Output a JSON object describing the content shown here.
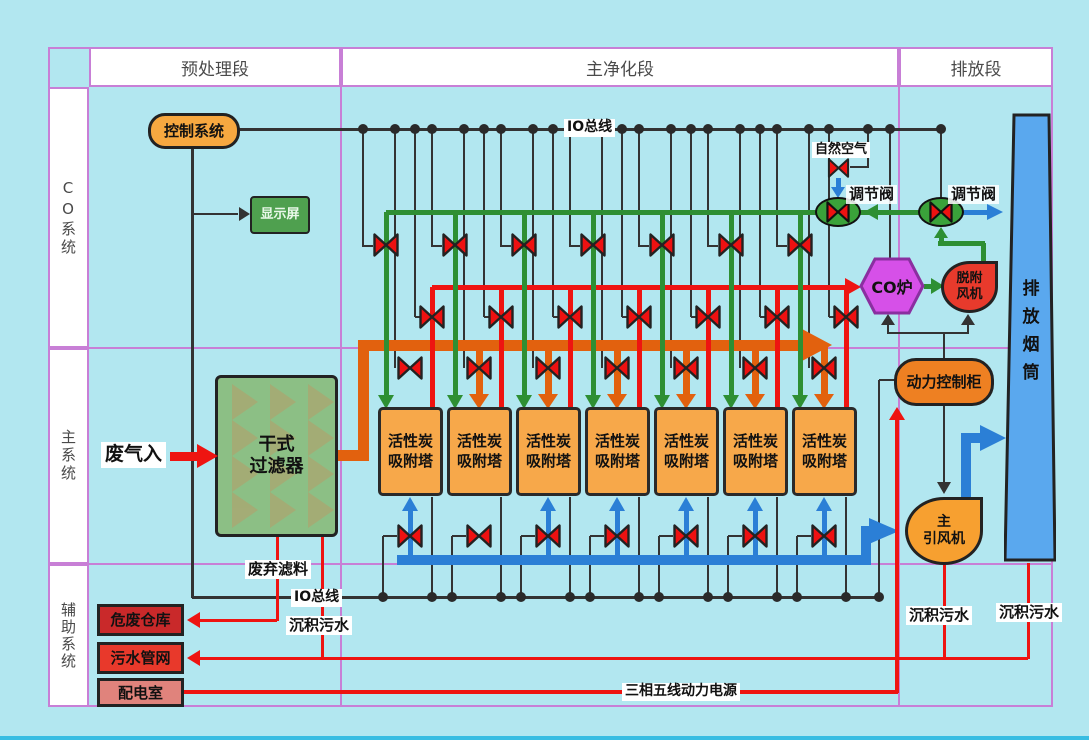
{
  "table": {
    "headers": [
      "预处理段",
      "主净化段",
      "排放段"
    ],
    "lanes": [
      "CO系统",
      "主系统",
      "辅助系统"
    ]
  },
  "equipment": {
    "control_system": "控制系统",
    "display_screen": "显示屏",
    "dry_filter": {
      "line1": "干式",
      "line2": "过滤器"
    },
    "co_furnace": "CO炉",
    "desorption_fan": {
      "line1": "脱附",
      "line2": "风机"
    },
    "exhaust_stack": "排放烟筒",
    "power_control_cabinet": "动力控制柜",
    "main_fan": {
      "line1": "主",
      "line2": "引风机"
    },
    "hazardous_waste_warehouse": "危废仓库",
    "sewage_pipe_network": "污水管网",
    "power_distribution_room": "配电室"
  },
  "towers": {
    "labels": [
      {
        "line1": "活性炭",
        "line2": "吸附塔"
      },
      {
        "line1": "活性炭",
        "line2": "吸附塔"
      },
      {
        "line1": "活性炭",
        "line2": "吸附塔"
      },
      {
        "line1": "活性炭",
        "line2": "吸附塔"
      },
      {
        "line1": "活性炭",
        "line2": "吸附塔"
      },
      {
        "line1": "活性炭",
        "line2": "吸附塔"
      },
      {
        "line1": "活性炭",
        "line2": "吸附塔"
      }
    ]
  },
  "labels": {
    "io_bus_top": "IO总线",
    "io_bus_bottom": "IO总线",
    "natural_air": "自然空气",
    "regulating_valve_left": "调节阀",
    "regulating_valve_right": "调节阀",
    "waste_gas_in": "废气入",
    "waste_filter_media": "废弃滤料",
    "sediment_sewage_filter": "沉积污水",
    "sediment_sewage_fan": "沉积污水",
    "sediment_sewage_stack": "沉积污水",
    "three_phase_power": "三相五线动力电源"
  },
  "colors": {
    "background": "#b2e7f0",
    "grid": "#c87fd6",
    "bus": "#333333",
    "dot": "#2a2a2a",
    "pipe_green": "#2e8f33",
    "pipe_red": "#ee1411",
    "pipe_orange": "#e2610e",
    "pipe_blue": "#2b7fd6",
    "valve_red": "#ee1111",
    "valve_green_body": "#3aa23a",
    "tower_fill": "#f7a84a",
    "stack_fill": "#5aa8ee",
    "filter_fill": "#8cbf85",
    "filter_zigzag": "#a6aa74",
    "co_furnace_fill": "#d650e8",
    "co_furnace_border": "#8a2fa0",
    "desorption_fan_fill": "#e83a2c",
    "cabinet_fill": "#ee8022",
    "main_fan_fill": "#f7a030",
    "control_box_fill": "#f7a840",
    "display_fill": "#4fa04f",
    "hazard_fill": "#c9292a",
    "sewage_fill": "#e8392b",
    "powerroom_fill": "#e0837c",
    "bottom_strip": "#38bde2"
  }
}
